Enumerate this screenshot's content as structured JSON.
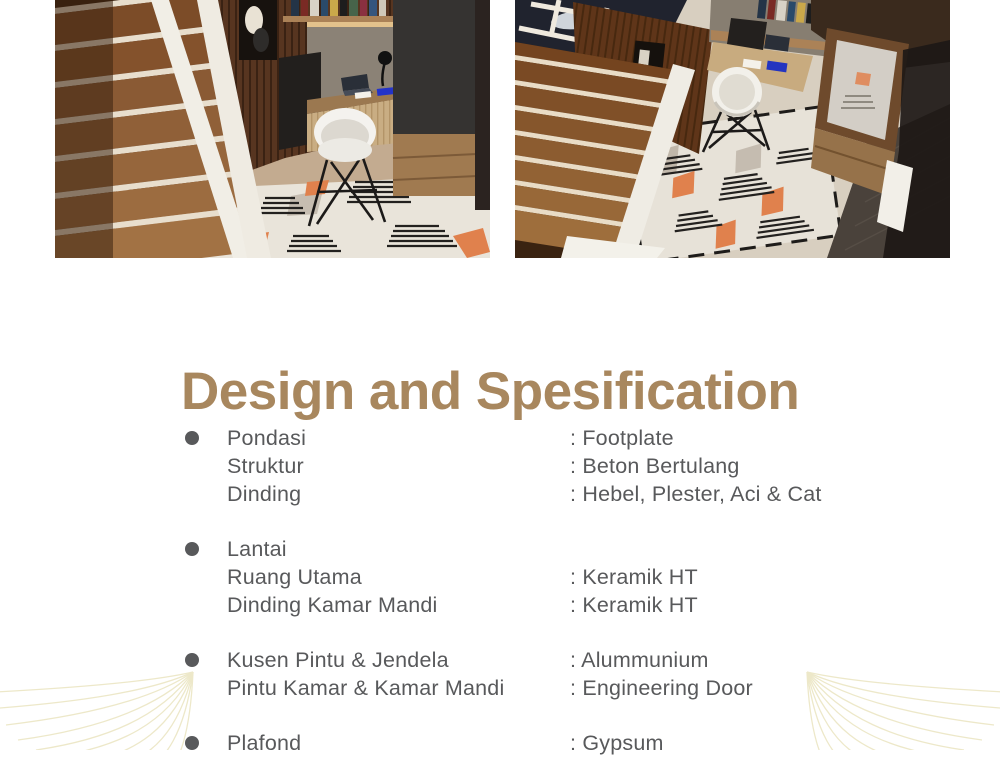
{
  "title": {
    "text": "Design and Spesification"
  },
  "colors": {
    "title_gold": "#a8875e",
    "body_text": "#58595b",
    "ornament": "#e7e1b8",
    "rug_orange": "#e0814d",
    "page_bg": "#ffffff"
  },
  "images": {
    "left": "interior-render-workspace-under-stairs",
    "right": "interior-render-overhead-view"
  },
  "specs": {
    "groups": [
      {
        "rows": [
          {
            "label": "Pondasi",
            "value": ": Footplate"
          },
          {
            "label": "Struktur",
            "value": ": Beton Bertulang"
          },
          {
            "label": "Dinding",
            "value": ": Hebel, Plester, Aci & Cat"
          }
        ]
      },
      {
        "rows": [
          {
            "label": "Lantai",
            "value": ""
          },
          {
            "label": "Ruang Utama",
            "value": ": Keramik HT"
          },
          {
            "label": "Dinding Kamar Mandi",
            "value": ": Keramik HT"
          }
        ]
      },
      {
        "rows": [
          {
            "label": "Kusen Pintu & Jendela",
            "value": ": Alummunium"
          },
          {
            "label": "Pintu Kamar & Kamar Mandi",
            "value": ": Engineering Door"
          }
        ]
      },
      {
        "rows": [
          {
            "label": "Plafond",
            "value": ": Gypsum"
          }
        ]
      }
    ]
  }
}
